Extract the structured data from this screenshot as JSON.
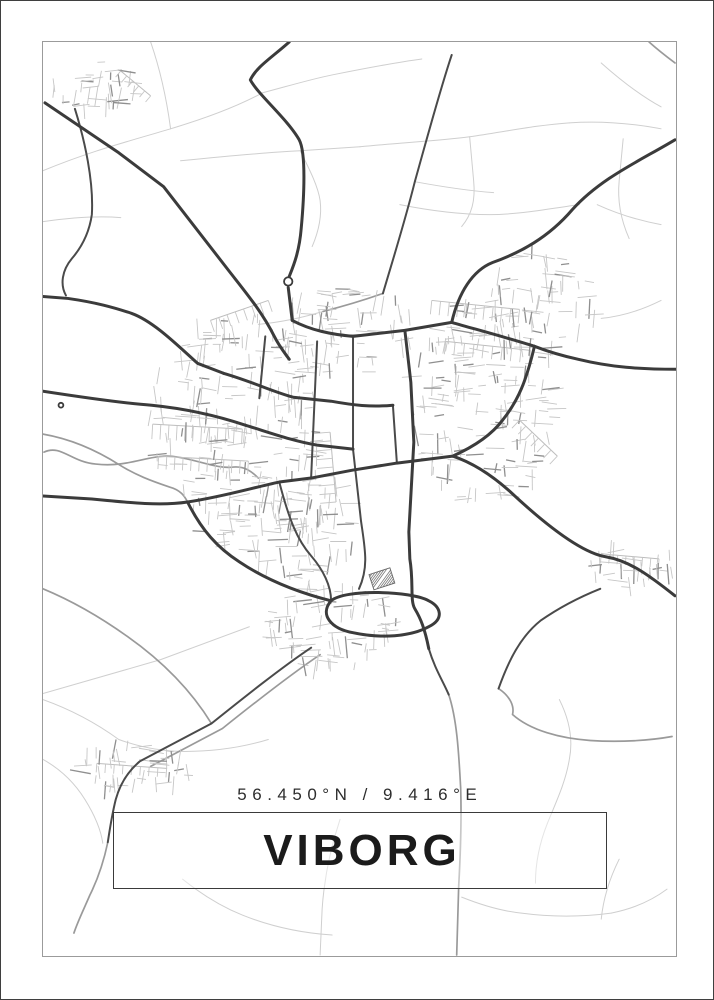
{
  "poster": {
    "coordinates": "56.450°N / 9.416°E",
    "title": "VIBORG"
  },
  "colors": {
    "background": "#ffffff",
    "outer_frame": "#3f3f3f",
    "map_border": "#9b9b9b",
    "title_box_border": "#3a3a3a",
    "text": "#1b1b1b",
    "road_major": "#3b3b3b",
    "road_secondary": "#4a4a4a",
    "road_medium": "#9a9a9a",
    "road_minor": "#cfcfcf",
    "road_tick": "#c6c6c6",
    "road_tick_dark": "#8f8f8f"
  },
  "map": {
    "view_box": "42 41 635 916",
    "roads": {
      "major": [
        "M44,102 L118,152 L163,186 L229,271 C247,294 262,312 274,336 C279,346 284,352 289,359",
        "M289,41 C271,57 256,66 250,79 C258,94 287,118 299,139 C306,152 304,196 301,228 C299,252 293,266 289,276",
        "M288,287 L292,320",
        "M676,139 C641,160 602,177 573,209 C549,237 521,252 493,262 C473,270 459,292 452,322",
        "M677,369 C641,369 612,367 579,359 C560,355 548,351 535,346",
        "M676,596 C652,577 631,561 607,557 C581,553 541,520 511,492 C491,474 471,462 453,456",
        "M42,296 L67,298 C95,302 113,307 131,313 C153,321 177,345 197,363 L223,373",
        "M42,391 C81,397 121,403 151,405 C191,409 221,417 245,425",
        "M42,496 L91,499 C131,503 161,506 187,502 C221,497 251,488 279,482 L311,478",
        "M292,320 C311,330 331,334 353,336 L405,330 L452,322",
        "M452,322 C480,330 510,338 535,346",
        "M223,373 C251,381 271,391 293,397 L331,401 C353,405 371,407 393,405",
        "M245,425 C271,433 293,441 317,445 L353,449",
        "M311,478 L353,470 L397,463 L453,456",
        "M405,330 L411,382 L414,442 L409,532 L410,559 C414,583 410,601 415,609 C421,619 425,629 429,649",
        "M331,601 C319,615 331,629 353,633 C381,639 411,637 429,627 C445,619 441,607 429,601 C411,591 345,589 331,601",
        "M535,346 C527,380 519,400 503,420 C491,436 471,448 453,456",
        "M187,502 C201,530 217,548 239,562 C263,578 295,592 331,601"
      ],
      "secondary": [
        "M353,336 L353,449",
        "M317,341 L311,477",
        "M393,405 L397,463",
        "M265,336 L259,398",
        "M279,482 C289,520 297,540 311,556 C323,570 331,586 331,601",
        "M74,108 C84,140 93,181 91,214 C89,228 83,244 71,258 C61,270 59,284 65,295",
        "M311,648 C281,668 241,700 211,724 L139,762 C127,772 119,786 115,800 C111,816 109,830 107,843",
        "M601,589 C581,597 561,607 541,621 C521,637 509,661 499,689",
        "M452,54 C440,90 429,131 415,181 C405,221 393,259 383,293",
        "M429,649 C435,669 443,681 449,695",
        "M353,449 L361,521 C365,549 369,567 359,589"
      ],
      "medium": [
        "M43,452 C60,444 70,462 95,464 C131,468 151,452 177,457 C201,461 217,469 233,467 C245,466 252,472 258,478",
        "M499,689 C511,697 515,707 513,715 C531,731 561,739 591,741 C621,743 651,741 673,737",
        "M42,434 C71,439 97,451 119,465 C135,475 151,481 169,487 C180,490 184,496 187,502",
        "M449,695 C457,719 459,751 461,789 C462,821 461,851 459,887 L457,956",
        "M107,843 C103,862 97,880 89,896 C83,910 77,922 73,934",
        "M383,293 C363,300 343,306 323,311",
        "M320,655 C290,675 252,705 222,729 L150,767",
        "M650,41 C660,50 668,56 676,62",
        "M211,724 C190,690 161,661 127,637 C99,617 71,601 42,589"
      ],
      "minor": [
        "M42,170 C90,150 130,140 170,128 C210,116 240,104 262,92",
        "M150,41 C160,70 166,98 170,128",
        "M262,92 C292,84 312,78 332,74 C362,68 392,62 422,58",
        "M180,160 C220,156 260,152 300,150 L360,146",
        "M300,150 C310,170 318,186 320,200 C322,216 318,232 312,246",
        "M360,146 C400,142 440,140 470,136 C510,130 540,124 570,122",
        "M470,136 L474,180 C476,200 472,214 462,226",
        "M570,122 C600,120 630,122 662,128",
        "M400,204 C430,210 460,214 490,214 C520,214 550,208 580,204",
        "M42,221 C70,217 96,215 120,217",
        "M602,62 C620,78 640,94 662,106",
        "M624,138 L620,180 C618,200 622,220 630,238",
        "M662,300 C642,310 622,316 602,318",
        "M560,700 C570,720 574,740 570,760 C566,784 556,804 548,824",
        "M620,860 C610,880 604,900 602,920",
        "M462,898 C482,906 502,912 522,914 C552,918 582,918 612,914",
        "M340,820 C330,850 324,880 322,910 L320,956",
        "M182,880 C202,896 222,908 242,916 C272,928 302,934 332,936",
        "M42,700 C70,710 96,724 118,740",
        "M42,760 C60,770 74,784 84,800",
        "M118,740 C140,748 162,752 184,752 C212,752 242,748 268,740",
        "M249,627 L160,660 L42,694",
        "M323,311 C300,318 280,322 258,324",
        "M415,181 C442,186 468,190 494,192",
        "M598,204 C620,214 640,220 662,224",
        "M84,800 C94,816 100,830 102,844",
        "M548,824 C540,844 536,864 536,884",
        "M612,914 C632,910 652,902 668,890"
      ]
    },
    "combs": [
      {
        "x1": 152,
        "y1": 424,
        "x2": 242,
        "y2": 429,
        "n": 12,
        "len": 15
      },
      {
        "x1": 158,
        "y1": 456,
        "x2": 248,
        "y2": 461,
        "n": 12,
        "len": 13
      },
      {
        "x1": 330,
        "y1": 432,
        "x2": 336,
        "y2": 502,
        "n": 9,
        "len": 16
      },
      {
        "x1": 432,
        "y1": 300,
        "x2": 520,
        "y2": 309,
        "n": 11,
        "len": 14
      },
      {
        "x1": 446,
        "y1": 341,
        "x2": 531,
        "y2": 350,
        "n": 10,
        "len": 13
      },
      {
        "x1": 520,
        "y1": 420,
        "x2": 558,
        "y2": 456,
        "n": 7,
        "len": 11
      },
      {
        "x1": 96,
        "y1": 764,
        "x2": 166,
        "y2": 769,
        "n": 9,
        "len": 9
      },
      {
        "x1": 602,
        "y1": 554,
        "x2": 660,
        "y2": 559,
        "n": 8,
        "len": 9
      },
      {
        "x1": 210,
        "y1": 320,
        "x2": 268,
        "y2": 300,
        "n": 8,
        "len": 12
      },
      {
        "x1": 120,
        "y1": 70,
        "x2": 150,
        "y2": 95,
        "n": 6,
        "len": 8
      }
    ],
    "clusters": [
      {
        "cx": 235,
        "cy": 430,
        "rx": 88,
        "ry": 118,
        "n": 210,
        "seed": 7
      },
      {
        "cx": 485,
        "cy": 400,
        "rx": 75,
        "ry": 105,
        "n": 170,
        "seed": 11
      },
      {
        "cx": 345,
        "cy": 330,
        "rx": 72,
        "ry": 45,
        "n": 80,
        "seed": 3
      },
      {
        "cx": 330,
        "cy": 628,
        "rx": 72,
        "ry": 44,
        "n": 85,
        "seed": 5
      },
      {
        "cx": 132,
        "cy": 770,
        "rx": 58,
        "ry": 24,
        "n": 46,
        "seed": 9
      },
      {
        "cx": 96,
        "cy": 88,
        "rx": 44,
        "ry": 27,
        "n": 38,
        "seed": 13
      },
      {
        "cx": 632,
        "cy": 566,
        "rx": 44,
        "ry": 22,
        "n": 36,
        "seed": 17
      },
      {
        "cx": 540,
        "cy": 300,
        "rx": 60,
        "ry": 50,
        "n": 70,
        "seed": 19
      },
      {
        "cx": 300,
        "cy": 520,
        "rx": 60,
        "ry": 60,
        "n": 90,
        "seed": 23
      }
    ],
    "roundabouts": [
      {
        "cx": 288,
        "cy": 281,
        "r": 4.2
      },
      {
        "cx": 60,
        "cy": 405,
        "r": 2.4
      }
    ],
    "hatch_block": {
      "x": 371,
      "y": 571,
      "w": 22,
      "h": 16,
      "angle": -18,
      "lines": 6
    }
  }
}
